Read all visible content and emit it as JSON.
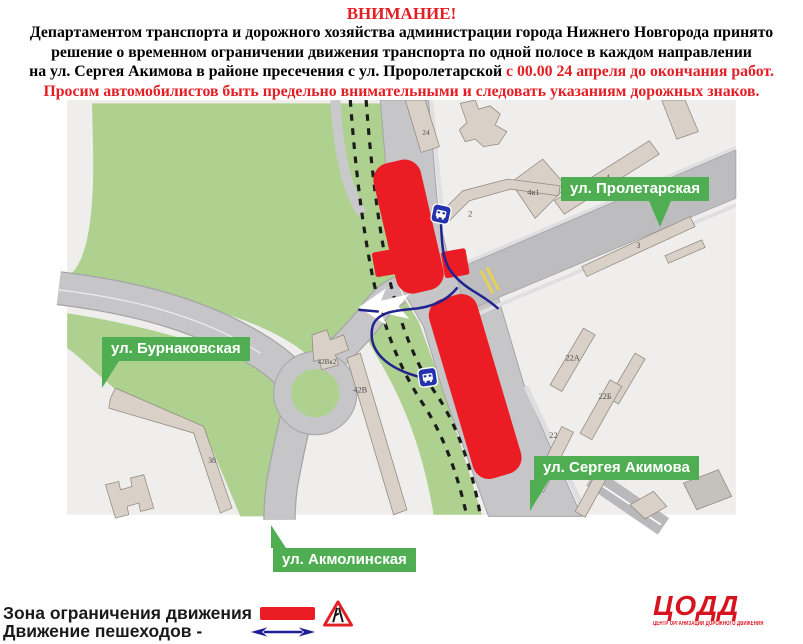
{
  "header": {
    "title": "ВНИМАНИЕ!",
    "line1": "Департаментом транспорта и дорожного хозяйства администрации города Нижнего Новгорода принято",
    "line2": "решение о временном ограничении движения транспорта по одной полосе в каждом направлении",
    "line3_black": "на ул. Сергея Акимова в районе пресечения с ул. Проролетарской ",
    "line3_red": "с 00.00 24 апреля до окончания работ.",
    "line4": "Просим автомобилистов быть предельно внимательными и следовать указаниям дорожных знаков."
  },
  "map": {
    "street_labels": {
      "proletarskaya": "ул. Пролетарская",
      "burnakovskaya": "ул. Бурнаковская",
      "akimova": "ул. Сергея Акимова",
      "akmolinskaya": "ул. Акмолинская"
    },
    "buildings": {
      "b2": "2",
      "b4": "4",
      "b4k1": "4к1",
      "b24": "24",
      "b3": "3",
      "b22a": "22А",
      "b22b": "22Б",
      "b22": "22",
      "b42v": "42В",
      "b42vk2": "42Вк2",
      "b38": "38"
    },
    "icons": {
      "bus_stop": "bus-stop-icon",
      "direction_arrow": "white-direction-arrow",
      "railway": "dashed-rail-line",
      "crosswalk": "yellow-crosswalk-marks"
    }
  },
  "legend": {
    "restriction_label": "Зона ограничения движения",
    "pedestrian_label": "Движение пешеходов -",
    "restriction_icon": "road-narrows-warning-sign",
    "pedestrian_icon": "blue-double-arrow"
  },
  "logo": {
    "title": "ЦОДД",
    "subtitle": "ЦЕНТР ОРГАНИЗАЦИИ ДОРОЖНОГО ДВИЖЕНИЯ"
  },
  "colors": {
    "alert_red": "#e31e24",
    "restriction_zone_red": "#ec1c24",
    "map_green": "#aed190",
    "tag_green": "#4fae52",
    "road_gray": "#c6c6c8",
    "building_beige": "#d9d1c7",
    "pedestrian_blue": "#23238f",
    "bus_icon_blue": "#2433ad",
    "logo_red": "#d7131f"
  }
}
